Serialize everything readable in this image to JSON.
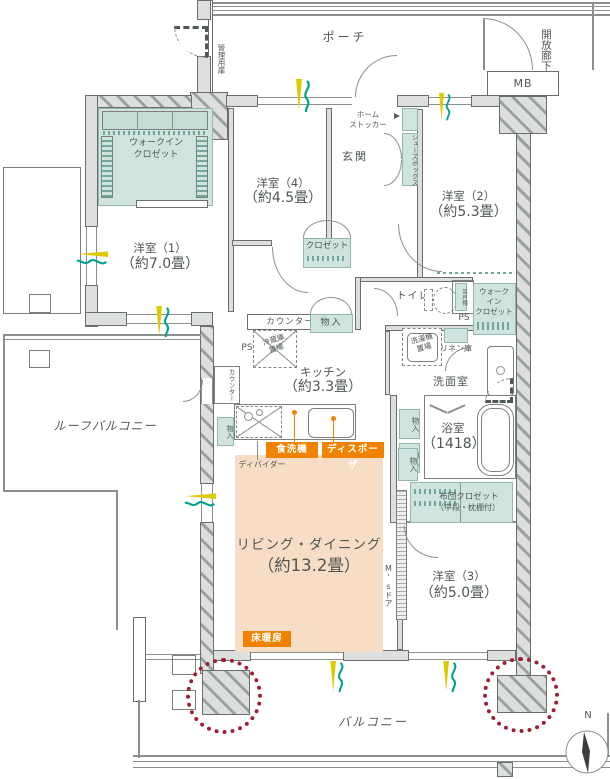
{
  "exterior": {
    "open_corridor": "開放廊下",
    "porch": "ポーチ",
    "meter_box": "MB",
    "management_door": "管理用扉",
    "roof_balcony": "ルーフバルコニー",
    "balcony": "バルコニー",
    "compass_north": "N"
  },
  "rooms": {
    "entrance": "玄関",
    "western1": {
      "name": "洋室（1）",
      "size": "（約7.0畳）"
    },
    "western2": {
      "name": "洋室（2）",
      "size": "（約5.3畳）"
    },
    "western3": {
      "name": "洋室（3）",
      "size": "（約5.0畳）"
    },
    "western4": {
      "name": "洋室（4）",
      "size": "（約4.5畳）"
    },
    "living_dining": {
      "name": "リビング・ダイニング",
      "size": "（約13.2畳）"
    },
    "kitchen": {
      "name": "キッチン",
      "size": "（約3.3畳）"
    },
    "bathroom": {
      "name": "浴室",
      "size": "（1418）"
    },
    "washroom": "洗面室",
    "toilet": "トイレ"
  },
  "storage": {
    "wic_left": [
      "ウォークイン",
      "クロゼット"
    ],
    "wic_right": [
      "ウォーク",
      "イン",
      "クロゼット"
    ],
    "closet": "クロゼット",
    "shoes_box": "シューズボックス",
    "home_stocker": [
      "ホーム",
      "ストッカー"
    ],
    "futon_closet": [
      "布団クロゼット",
      "（中段・枕棚付）"
    ],
    "linen": "リネン庫",
    "small_storage": "物入",
    "hanging_cabinet": "吊戸棚"
  },
  "fixtures": {
    "counter": "カウンター",
    "pipe_space": "PS",
    "fridge_space": [
      "冷蔵庫",
      "置場"
    ],
    "washer_space": [
      "洗濯機",
      "置場"
    ],
    "dishwasher": "食洗機",
    "disposer": "ディスポーザ",
    "divider": "ディバイダー",
    "ms_door": "M'sドア",
    "floor_heating": "床暖房"
  },
  "colors": {
    "storage_fill": "#cfe4df",
    "accent_orange": "#ef8200",
    "living_fill": "#f8ddc6",
    "pillar_highlight": "#9c2033",
    "symbol_yellow": "#ddca00",
    "symbol_teal": "#00a08e",
    "wall_fill": "#dcdfdd"
  }
}
